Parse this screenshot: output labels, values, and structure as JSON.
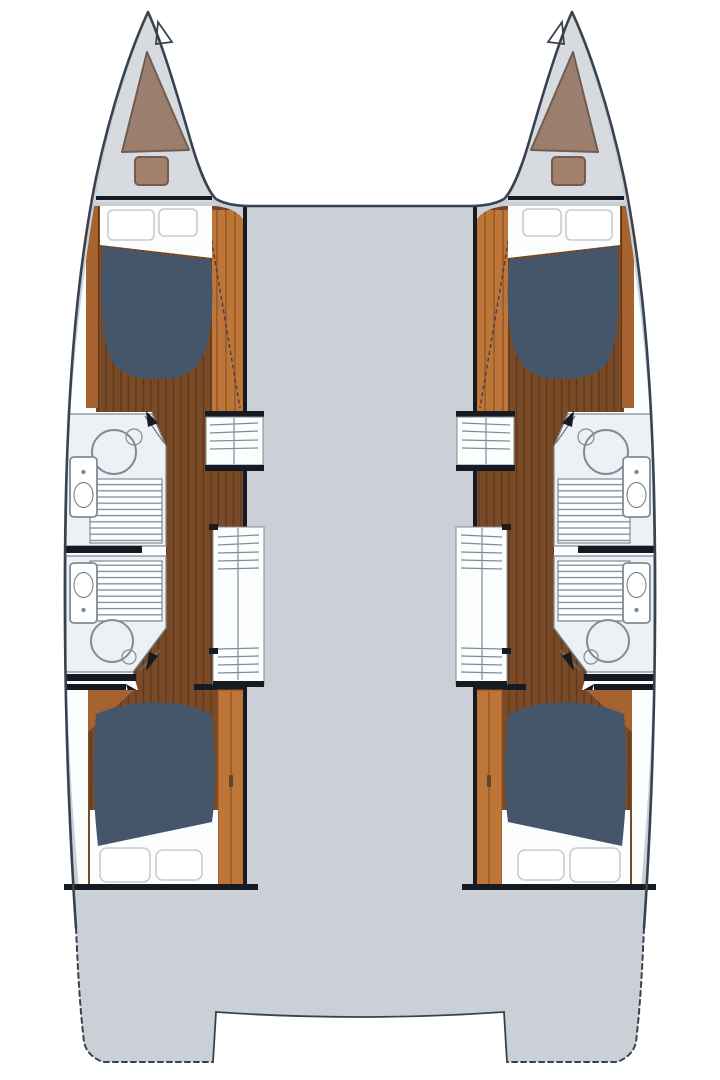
{
  "document": {
    "type": "floor-plan",
    "subject": "catamaran-yacht-interior-layout",
    "view": "top-down",
    "text_labels": []
  },
  "palette": {
    "background": "#ffffff",
    "deck": "#cbd0d6",
    "shell": "#d7dade",
    "outline": "#39434f",
    "wall": "#161b23",
    "room": "#fcfdfd",
    "head-floor": "#eef1f4",
    "bed": "#46566a",
    "wood-dark": "#7a4a27",
    "wood-dark-line": "#5e381c",
    "wood-mid": "#a5642f",
    "wood-light": "#bd7538",
    "wood-light-line": "#8d5020",
    "taupe": "#9c7e6e",
    "taupe-cushion": "#a3806c",
    "taupe-border": "#715c51",
    "fixture": "#7e8b99",
    "pillow": "#ffffff",
    "pillow-border": "#c6ccd2",
    "door-line": "#6c7683"
  },
  "features": {
    "port_hull": [
      "forepeak",
      "forward-cabin",
      "forward-head",
      "aft-head",
      "companionway",
      "aft-cabin",
      "transom-platform"
    ],
    "starboard_hull": [
      "forepeak",
      "forward-cabin",
      "forward-head",
      "aft-head",
      "companionway",
      "aft-cabin",
      "transom-platform"
    ],
    "center": [
      "foredeck-gap",
      "bridgedeck",
      "cockpit",
      "transom-notch"
    ]
  },
  "fixtures": {
    "double_beds": 4,
    "pillows": 8,
    "toilets": 4,
    "showers": 4,
    "shower_grates": 4,
    "forepeak_cushions": 2,
    "companionway_step_units": 4
  }
}
